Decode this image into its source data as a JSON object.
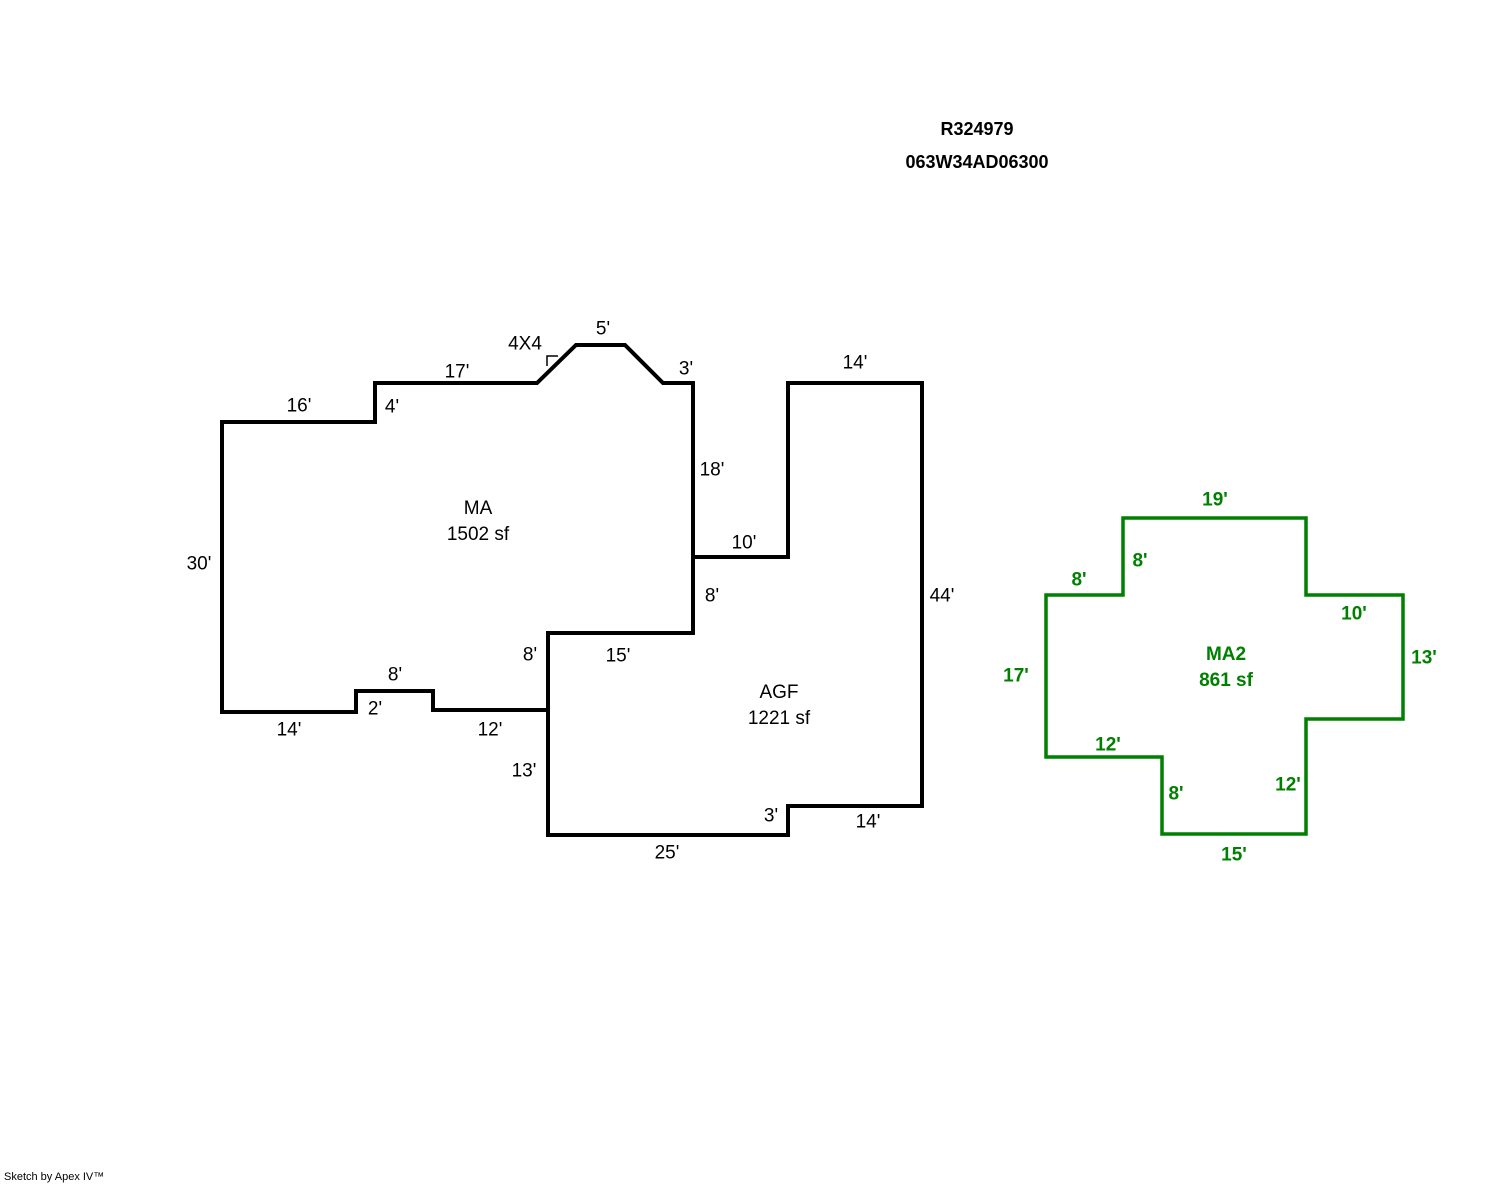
{
  "header": {
    "parcel_id": "R324979",
    "account_id": "063W34AD06300"
  },
  "footer": {
    "credit": "Sketch by Apex IV™"
  },
  "colors": {
    "background": "#ffffff",
    "outline_primary": "#000000",
    "outline_secondary": "#008000"
  },
  "areas": {
    "ma": {
      "name": "MA",
      "size": "1502 sf"
    },
    "agf": {
      "name": "AGF",
      "size": "1221 sf"
    },
    "ma2": {
      "name": "MA2",
      "size": "861 sf"
    }
  },
  "dimension_labels": {
    "black": [
      {
        "text": "16'",
        "x": 299,
        "y": 406
      },
      {
        "text": "4'",
        "x": 392,
        "y": 407
      },
      {
        "text": "17'",
        "x": 457,
        "y": 372
      },
      {
        "text": "4X4",
        "x": 525,
        "y": 344
      },
      {
        "text": "5'",
        "x": 603,
        "y": 329
      },
      {
        "text": "3'",
        "x": 686,
        "y": 369
      },
      {
        "text": "14'",
        "x": 855,
        "y": 363
      },
      {
        "text": "18'",
        "x": 712,
        "y": 470
      },
      {
        "text": "10'",
        "x": 744,
        "y": 543
      },
      {
        "text": "8'",
        "x": 712,
        "y": 596
      },
      {
        "text": "44'",
        "x": 942,
        "y": 596
      },
      {
        "text": "30'",
        "x": 199,
        "y": 564
      },
      {
        "text": "8'",
        "x": 395,
        "y": 675
      },
      {
        "text": "2'",
        "x": 375,
        "y": 709
      },
      {
        "text": "14'",
        "x": 289,
        "y": 730
      },
      {
        "text": "12'",
        "x": 490,
        "y": 730
      },
      {
        "text": "8'",
        "x": 530,
        "y": 655
      },
      {
        "text": "15'",
        "x": 618,
        "y": 656
      },
      {
        "text": "13'",
        "x": 524,
        "y": 771
      },
      {
        "text": "3'",
        "x": 771,
        "y": 816
      },
      {
        "text": "14'",
        "x": 868,
        "y": 822
      },
      {
        "text": "25'",
        "x": 667,
        "y": 853
      }
    ],
    "green": [
      {
        "text": "19'",
        "x": 1215,
        "y": 500
      },
      {
        "text": "8'",
        "x": 1140,
        "y": 561
      },
      {
        "text": "8'",
        "x": 1079,
        "y": 580
      },
      {
        "text": "10'",
        "x": 1354,
        "y": 614
      },
      {
        "text": "13'",
        "x": 1424,
        "y": 658
      },
      {
        "text": "17'",
        "x": 1016,
        "y": 676
      },
      {
        "text": "12'",
        "x": 1108,
        "y": 745
      },
      {
        "text": "8'",
        "x": 1176,
        "y": 794
      },
      {
        "text": "12'",
        "x": 1288,
        "y": 785
      },
      {
        "text": "15'",
        "x": 1234,
        "y": 855
      }
    ]
  }
}
